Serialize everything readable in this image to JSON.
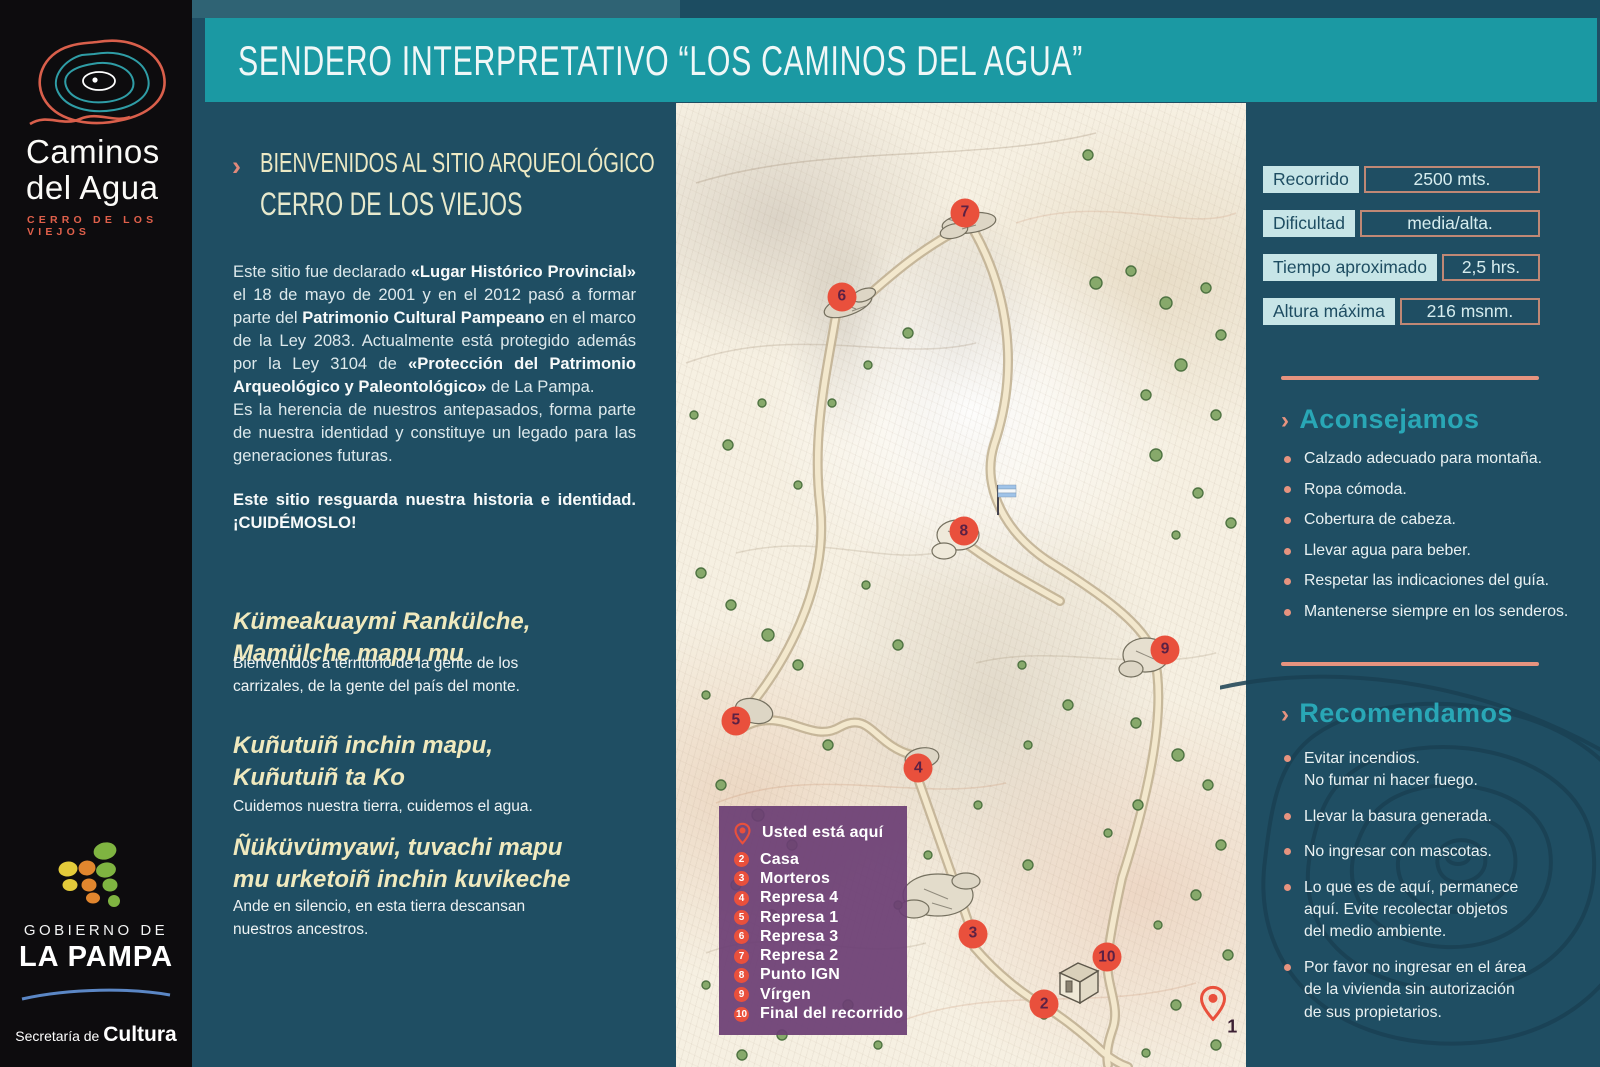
{
  "brand": {
    "name_line1": "Caminos",
    "name_line2": "del Agua",
    "subtitle": "CERRO DE LOS VIEJOS"
  },
  "header": {
    "title": "SENDERO INTERPRETATIVO “LOS CAMINOS DEL AGUA”"
  },
  "intro": {
    "heading_line1": "BIENVENIDOS AL SITIO ARQUEOLÓGICO",
    "heading_line2": "CERRO DE LOS VIEJOS",
    "heading_chevron": "›",
    "p1": [
      {
        "t": "Este sitio fue declarado "
      },
      {
        "t": "«Lugar Histórico Provincial»"
      },
      {
        "t": " el 18 de mayo de 2001 y en el 2012 pasó a formar parte del "
      },
      {
        "t": "Patrimonio Cultural Pampeano"
      },
      {
        "t": " en el marco de la Ley 2083. Actualmente está protegido además por la Ley 3104 de "
      },
      {
        "t": "«Protección del Patrimonio Arqueológico y Paleontológico»"
      },
      {
        "t": " de La Pampa."
      }
    ],
    "p2": "Es la herencia de nuestros antepasados, forma parte de nuestra identidad y constituye un legado para las generaciones futuras.",
    "p3": "Este sitio resguarda nuestra historia e identidad. ¡CUIDÉMOSLO!"
  },
  "quotes": [
    {
      "head1": "Kümeakuaymi Rankülche,",
      "head2": "Mamülche mapu mu",
      "caption": "Bienvenidos a territorio de la gente de los carrizales, de la gente del país del monte."
    },
    {
      "head1": "Kuñutuiñ inchin mapu,",
      "head2": "Kuñutuiñ ta Ko",
      "caption": "Cuidemos nuestra tierra, cuidemos el agua."
    },
    {
      "head1": "Ñüküvümyawi, tuvachi mapu",
      "head2": "mu urketoiñ inchin kuvikeche",
      "caption": "Ande en silencio, en esta tierra descansan nuestros ancestros."
    }
  ],
  "stats": [
    {
      "label": "Recorrido",
      "value": "2500 mts."
    },
    {
      "label": "Dificultad",
      "value": "media/alta."
    },
    {
      "label": "Tiempo aproximado",
      "value": "2,5 hrs."
    },
    {
      "label": "Altura máxima",
      "value": "216 msnm."
    }
  ],
  "advice": {
    "chevron": "›",
    "title": "Aconsejamos",
    "items": [
      "Calzado adecuado para montaña.",
      "Ropa cómoda.",
      "Cobertura de cabeza.",
      "Llevar agua para beber.",
      "Respetar las indicaciones del guía.",
      "Mantenerse siempre en los senderos."
    ]
  },
  "recommend": {
    "chevron": "›",
    "title": "Recomendamos",
    "items": [
      "Evitar incendios.\nNo fumar ni hacer fuego.",
      "Llevar la basura generada.",
      "No ingresar con mascotas.",
      "Lo que es de aquí, permanece\naquí. Evite recolectar objetos\ndel medio ambiente.",
      "Por favor no ingresar en el área\nde la vivienda sin autorización\nde sus propietarios."
    ]
  },
  "map": {
    "legend": {
      "you_are_here": "Usted está aquí",
      "items": [
        {
          "num": "2",
          "label": "Casa"
        },
        {
          "num": "3",
          "label": "Morteros"
        },
        {
          "num": "4",
          "label": "Represa 4"
        },
        {
          "num": "5",
          "label": "Represa 1"
        },
        {
          "num": "6",
          "label": "Represa 3"
        },
        {
          "num": "7",
          "label": "Represa 2"
        },
        {
          "num": "8",
          "label": "Punto IGN"
        },
        {
          "num": "9",
          "label": "Vírgen"
        },
        {
          "num": "10",
          "label": "Final del recorrido"
        }
      ]
    },
    "markers": [
      {
        "num": "7",
        "style": "left:50.7%;top:11.4%"
      },
      {
        "num": "6",
        "style": "left:29.1%;top:20.1%"
      },
      {
        "num": "8",
        "style": "left:50.5%;top:44.4%"
      },
      {
        "num": "9",
        "style": "left:85.8%;top:56.7%"
      },
      {
        "num": "5",
        "style": "left:10.5%;top:64.1%"
      },
      {
        "num": "4",
        "style": "left:42.5%;top:69.0%"
      },
      {
        "num": "3",
        "style": "left:52.1%;top:86.2%"
      },
      {
        "num": "10",
        "style": "left:75.6%;top:88.6%"
      },
      {
        "num": "2",
        "style": "left:64.6%;top:93.5%"
      }
    ],
    "pin_label": "1"
  },
  "gov": {
    "line1": "GOBIERNO DE",
    "line2": "LA PAMPA",
    "line3_regular": "Secretaría de ",
    "line3_bold": "Cultura"
  },
  "colors": {
    "background": "#1f4e63",
    "title_bar": "#1b99a3",
    "cream_heading": "#ece9c4",
    "salmon_accent": "#e6937f",
    "section_heading_teal": "#29a7b6",
    "stat_chip": "#c7e5e7",
    "stat_text_navy": "#1e4d62",
    "legend_purple": "#6c3e74",
    "marker_red": "#e9503c",
    "marker_number_plum": "#5c2144",
    "sidebar_black": "#0d0c0e",
    "logo_red": "#d95f4b",
    "logo_teal": "#2f9da6"
  }
}
